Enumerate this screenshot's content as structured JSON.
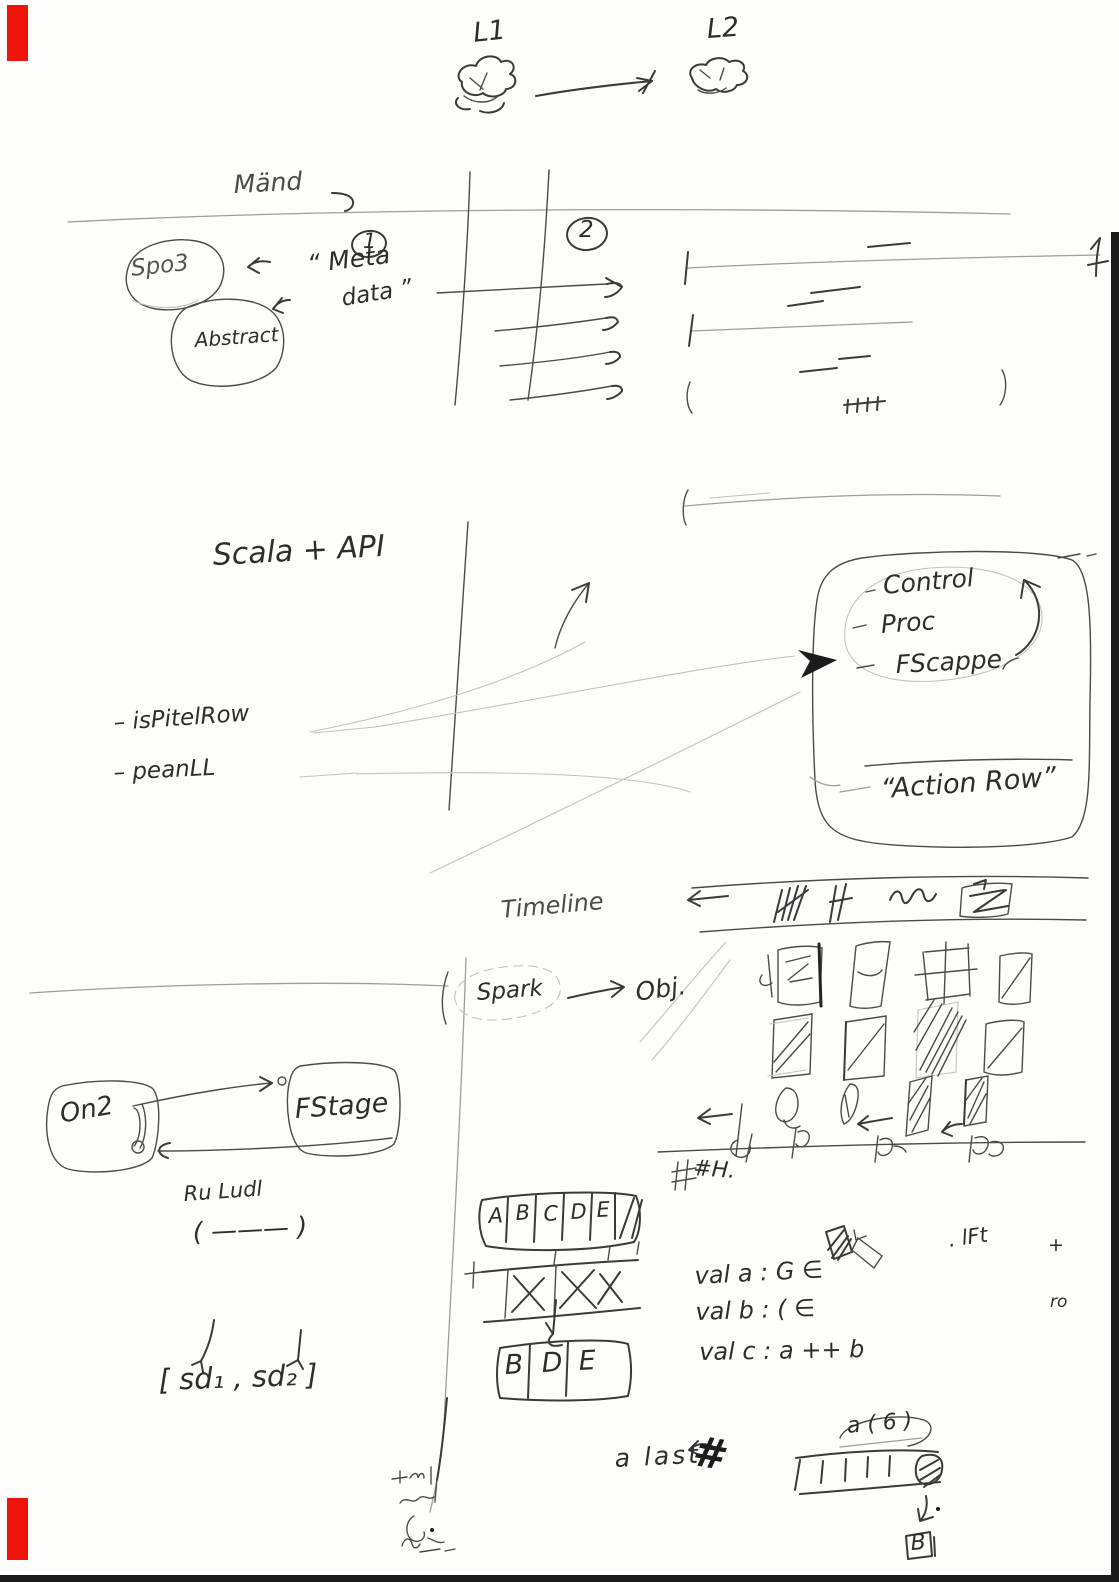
{
  "colors": {
    "paper": "#fdfdfb",
    "ink": "#3a3a3a",
    "faint_pencil": "#9d9d9d",
    "red_edge_mark": "#ee1409",
    "scan_border": "#0b0b0b"
  },
  "top_clouds": {
    "left_label": "L1",
    "right_label": "L2"
  },
  "meta_row": {
    "heading": "Mänd",
    "step_1": "1",
    "step_2": "2",
    "spark_ellipse": "Spo3",
    "abstract_blob": "Abstract",
    "meta_label_line1": "“ Meta",
    "meta_label_line2": "data ”"
  },
  "scala": {
    "title": "Scala + API",
    "bullet_1": "– isPitelRow",
    "bullet_2": "– peanLL"
  },
  "action_box": {
    "item_1": "Control",
    "item_2": "Proc",
    "item_3": "FScappe",
    "caption": "“Action Row”"
  },
  "spark_flow": {
    "title": "Timeline",
    "source": "Spark",
    "target": "Obj."
  },
  "fs_flow": {
    "left_box": "On2",
    "right_box": "FStage",
    "note": "Ru Ludl",
    "paren_note": "( ——— )",
    "pair_note": "[ sd₁ , sd₂ ]"
  },
  "table": {
    "header": [
      "A",
      "B",
      "C",
      "D",
      "E"
    ],
    "crossed": [
      "X",
      "X",
      "X"
    ],
    "result": [
      "B",
      "D",
      "E"
    ]
  },
  "vals": {
    "line_a": "val a : G ∈",
    "line_b": "val b : ( ∈",
    "line_c": "val c :  a ++ b",
    "ref_mark": ". lFt",
    "plus_mark": "+",
    "ro_mark": "ro",
    "hash_mark": "#H.",
    "a_last": "a last",
    "strike": "#",
    "a6": "a ( 6 )",
    "b_box": "B"
  }
}
